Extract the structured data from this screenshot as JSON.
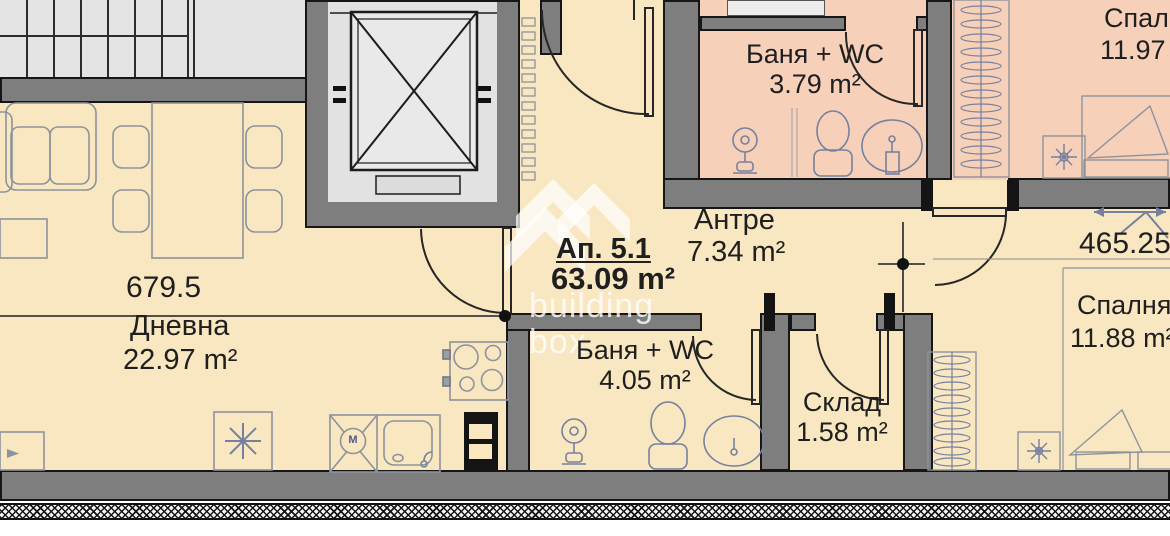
{
  "palette": {
    "room_cream": "#f8e7c0",
    "room_pink": "#f7d0ba",
    "wall_gray": "#7e7e7e",
    "common_light_gray": "#e4e4e4",
    "outline_black": "#161616",
    "fixture_blue": "#76819f",
    "furniture_gray": "#8d939c",
    "text": "#1f1f1f",
    "watermark_white": "#ffffff"
  },
  "apartment": {
    "label": "Ап. 5.1",
    "area": "63.09 m²"
  },
  "rooms": {
    "living": {
      "name": "Дневна",
      "area": "22.97 m²"
    },
    "hallway": {
      "name": "Антре",
      "area": "7.34 m²"
    },
    "bathroom_top": {
      "name": "Баня + WC",
      "area": "3.79 m²"
    },
    "bathroom_bottom": {
      "name": "Баня + WC",
      "area": "4.05 m²"
    },
    "storage": {
      "name": "Склад",
      "area": "1.58 m²"
    },
    "bedroom_top": {
      "name": "Спалня",
      "area": "11.97"
    },
    "bedroom_bottom": {
      "name": "Спалня",
      "area": "11.88 m²"
    }
  },
  "dimensions": {
    "living_width": "679.5",
    "bedroom_width": "465.25"
  },
  "watermark": {
    "line1": "building",
    "line2": "box"
  },
  "icons": {
    "washing_machine_letter": "M"
  }
}
